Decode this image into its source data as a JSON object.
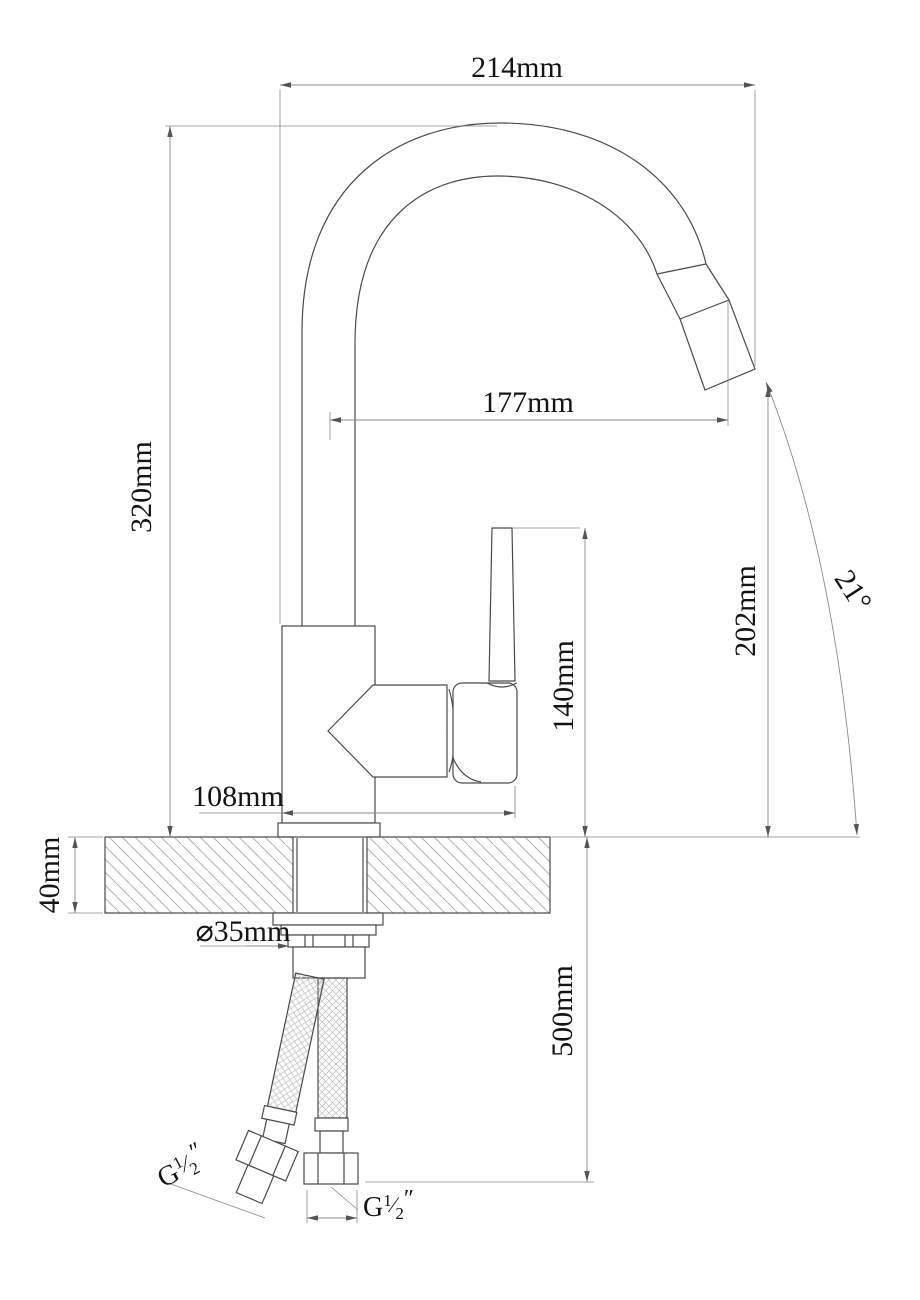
{
  "meta": {
    "type": "technical-drawing",
    "subject": "single-handle kitchen faucet installation drawing",
    "canvas": {
      "width": 920,
      "height": 1300
    }
  },
  "colors": {
    "background": "#ffffff",
    "outline": "#4a4a4a",
    "dimension_line": "#8a8a8a",
    "arrow": "#555555",
    "text": "#141414",
    "hatch": "#b0b0b0",
    "braid": "#bdbdbd"
  },
  "labels": {
    "spout_overall_width": "214mm",
    "spout_reach": "177mm",
    "overall_height": "320mm",
    "handle_height": "140mm",
    "outlet_height": "202mm",
    "outlet_angle": "21°",
    "base_length": "108mm",
    "deck_thickness": "40mm",
    "hole_diameter": "⌀35mm",
    "hose_length": "500mm"
  },
  "thread_left": {
    "prefix": "G",
    "numerator": "1",
    "slash": "⁄",
    "denominator": "2",
    "unit": "″"
  },
  "thread_right": {
    "prefix": "G",
    "numerator": "1",
    "slash": "⁄",
    "denominator": "2",
    "unit": "″"
  }
}
